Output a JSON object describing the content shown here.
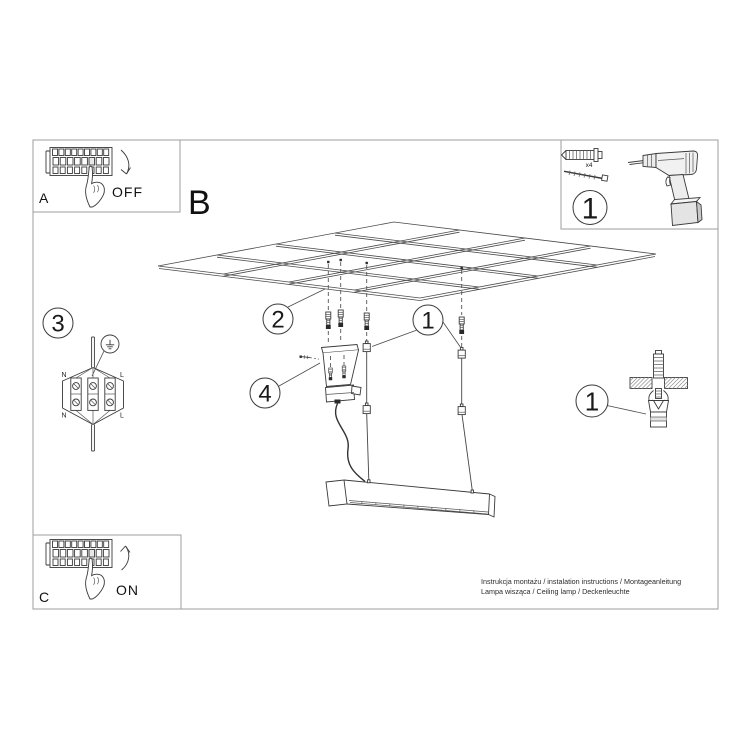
{
  "steps": {
    "a": {
      "label": "A",
      "state": "OFF"
    },
    "b": {
      "label": "B"
    },
    "c": {
      "label": "C",
      "state": "ON"
    }
  },
  "callouts": {
    "tools": "1",
    "ceiling": "2",
    "wiring": "3",
    "canopy": "4",
    "suspension": "1",
    "anchor": "1"
  },
  "tools": {
    "plug_qty": "x4"
  },
  "wiring": {
    "top_left": "N",
    "top_right": "L",
    "bottom_left": "N",
    "bottom_right": "L"
  },
  "footer": {
    "line1": "Instrukcja montażu / instalation instructions / Montageanleitung",
    "line2": "Lampa wisząca / Ceiling lamp / Deckenleuchte"
  },
  "colors": {
    "line": "#3a3a3a",
    "frame": "#9e9e9e",
    "background": "#ffffff"
  }
}
